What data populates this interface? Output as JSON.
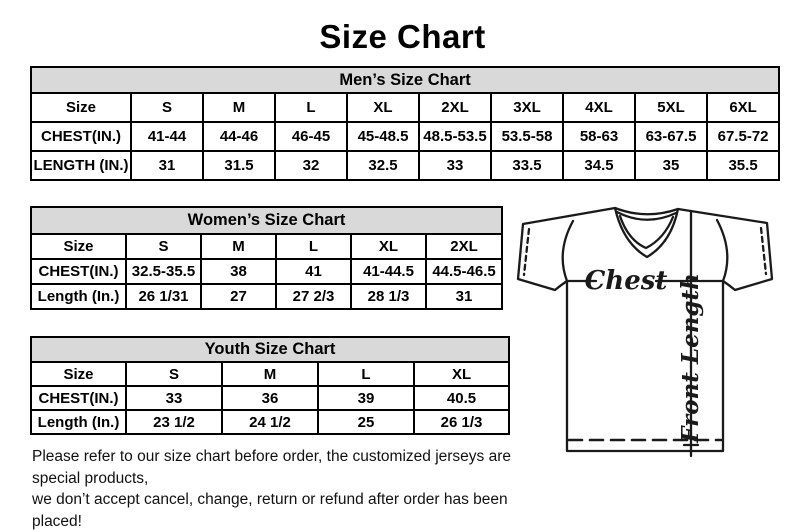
{
  "page": {
    "title": "Size Chart"
  },
  "mens_chart": {
    "title": "Men’s Size Chart",
    "row_labels": [
      "Size",
      "CHEST(IN.)",
      "LENGTH (IN.)"
    ],
    "sizes": [
      "S",
      "M",
      "L",
      "XL",
      "2XL",
      "3XL",
      "4XL",
      "5XL",
      "6XL"
    ],
    "chest": [
      "41-44",
      "44-46",
      "46-45",
      "45-48.5",
      "48.5-53.5",
      "53.5-58",
      "58-63",
      "63-67.5",
      "67.5-72"
    ],
    "length": [
      "31",
      "31.5",
      "32",
      "32.5",
      "33",
      "33.5",
      "34.5",
      "35",
      "35.5"
    ]
  },
  "womens_chart": {
    "title": "Women’s Size Chart",
    "row_labels": [
      "Size",
      "CHEST(IN.)",
      "Length (In.)"
    ],
    "sizes": [
      "S",
      "M",
      "L",
      "XL",
      "2XL"
    ],
    "chest": [
      "32.5-35.5",
      "38",
      "41",
      "41-44.5",
      "44.5-46.5"
    ],
    "length": [
      "26 1/31",
      "27",
      "27 2/3",
      "28 1/3",
      "31"
    ]
  },
  "youth_chart": {
    "title": "Youth Size Chart",
    "row_labels": [
      "Size",
      "CHEST(IN.)",
      "Length (In.)"
    ],
    "sizes": [
      "S",
      "M",
      "L",
      "XL"
    ],
    "chest": [
      "33",
      "36",
      "39",
      "40.5"
    ],
    "length": [
      "23 1/2",
      "24 1/2",
      "25",
      "26 1/3"
    ]
  },
  "diagram": {
    "chest_label": "Chest",
    "front_length_label": "Front Length"
  },
  "footer": {
    "line1": "Please refer to our size chart before order, the customized jerseys are special products,",
    "line2": "we don’t accept cancel, change, return or refund after order has been placed!"
  },
  "colors": {
    "table_header_bg": "#d9d9d9",
    "border": "#000000",
    "text": "#000000",
    "background": "#ffffff"
  }
}
